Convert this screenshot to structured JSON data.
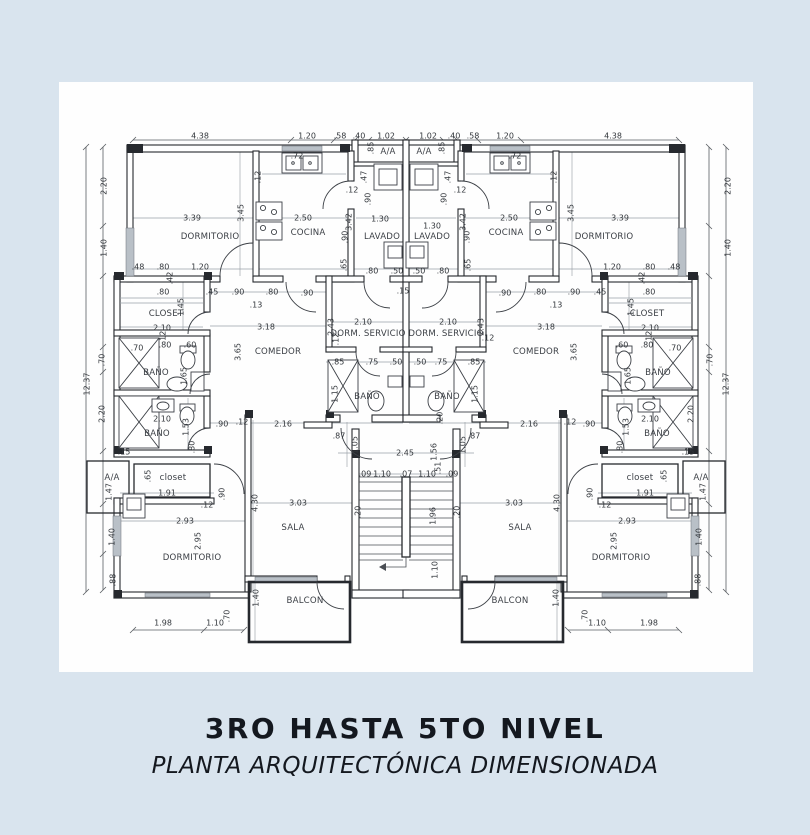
{
  "page": {
    "background": "#d9e4ee",
    "paper": "#fefefe",
    "ink": "#14181f",
    "line": "#26292e"
  },
  "titleblock": {
    "line1": "3RO HASTA 5TO NIVEL",
    "line2": "PLANTA ARQUITECTÓNICA DIMENSIONADA"
  },
  "plan": {
    "room_names": [
      "DORMITORIO",
      "COCINA",
      "LAVADO",
      "A/A",
      "CLOSET",
      "COMEDOR",
      "DORM. SERVICIO",
      "BAÑO",
      "SALA",
      "BALCON",
      "closet"
    ],
    "labels": [
      [
        "r",
        "DORMITORIO",
        210,
        237
      ],
      [
        "r",
        "COCINA",
        308,
        233
      ],
      [
        "r",
        "LAVADO",
        382,
        237
      ],
      [
        "r",
        "LAVADO",
        432,
        237
      ],
      [
        "r",
        "COCINA",
        506,
        233
      ],
      [
        "r",
        "DORMITORIO",
        604,
        237
      ],
      [
        "r",
        "A/A",
        388,
        152
      ],
      [
        "r",
        "A/A",
        424,
        152
      ],
      [
        "r",
        "CLOSET",
        166,
        314
      ],
      [
        "r",
        "CLOSET",
        647,
        314
      ],
      [
        "r",
        "COMEDOR",
        278,
        352
      ],
      [
        "r",
        "COMEDOR",
        536,
        352
      ],
      [
        "r",
        "DORM. SERVICIO",
        368,
        334
      ],
      [
        "r",
        "DORM. SERVICIO",
        446,
        334
      ],
      [
        "r",
        "BAÑO",
        156,
        373
      ],
      [
        "r",
        "BAÑO",
        658,
        373
      ],
      [
        "r",
        "BAÑO",
        367,
        397
      ],
      [
        "r",
        "BAÑO",
        447,
        397
      ],
      [
        "r",
        "BAÑO",
        157,
        434
      ],
      [
        "r",
        "BAÑO",
        657,
        434
      ],
      [
        "r",
        "A/A",
        112,
        478
      ],
      [
        "r",
        "closet",
        173,
        478
      ],
      [
        "r",
        "closet",
        640,
        478
      ],
      [
        "r",
        "A/A",
        701,
        478
      ],
      [
        "r",
        "DORMITORIO",
        192,
        558
      ],
      [
        "r",
        "DORMITORIO",
        621,
        558
      ],
      [
        "r",
        "SALA",
        293,
        528
      ],
      [
        "r",
        "SALA",
        520,
        528
      ],
      [
        "r",
        "BALCON",
        305,
        601
      ],
      [
        "r",
        "BALCON",
        510,
        601
      ],
      [
        "d",
        "4.38",
        200,
        136
      ],
      [
        "d",
        "1.20",
        307,
        136
      ],
      [
        "d",
        ".58",
        340,
        136
      ],
      [
        "d",
        ".40",
        359,
        136
      ],
      [
        "d",
        "1.02",
        386,
        136
      ],
      [
        "d",
        "1.02",
        428,
        136
      ],
      [
        "d",
        ".40",
        454,
        136
      ],
      [
        "d",
        ".58",
        473,
        136
      ],
      [
        "d",
        "1.20",
        505,
        136
      ],
      [
        "d",
        "4.38",
        613,
        136
      ],
      [
        "d",
        ".85",
        371,
        148,
        1
      ],
      [
        "d",
        ".85",
        442,
        148,
        1
      ],
      [
        "d",
        "2.20",
        104,
        186,
        1
      ],
      [
        "d",
        "1.40",
        104,
        248,
        1
      ],
      [
        "d",
        "12.37",
        87,
        384,
        1
      ],
      [
        "d",
        ".70",
        102,
        360,
        1
      ],
      [
        "d",
        "2.20",
        102,
        414,
        1
      ],
      [
        "d",
        "1.47",
        109,
        492,
        1
      ],
      [
        "d",
        "1.40",
        112,
        537,
        1
      ],
      [
        "d",
        ".88",
        113,
        580,
        1
      ],
      [
        "d",
        "2.20",
        728,
        186,
        1
      ],
      [
        "d",
        "1.40",
        728,
        248,
        1
      ],
      [
        "d",
        "12.37",
        726,
        384,
        1
      ],
      [
        "d",
        ".70",
        710,
        360,
        1
      ],
      [
        "d",
        "2.20",
        691,
        414,
        1
      ],
      [
        "d",
        "1.47",
        703,
        492,
        1
      ],
      [
        "d",
        "1.40",
        699,
        537,
        1
      ],
      [
        "d",
        ".88",
        698,
        580,
        1
      ],
      [
        "d",
        ".72",
        297,
        156
      ],
      [
        "d",
        "3.39",
        192,
        218
      ],
      [
        "d",
        "3.45",
        241,
        213,
        1
      ],
      [
        "d",
        "2.50",
        303,
        218
      ],
      [
        "d",
        ".12",
        258,
        177,
        1
      ],
      [
        "d",
        ".47",
        364,
        177,
        1
      ],
      [
        "d",
        ".90",
        368,
        199,
        1
      ],
      [
        "d",
        "1.30",
        380,
        219
      ],
      [
        "d",
        "3.42",
        349,
        222,
        1
      ],
      [
        "d",
        ".90",
        345,
        237,
        1
      ],
      [
        "d",
        ".65",
        344,
        265,
        1
      ],
      [
        "d",
        ".12",
        352,
        190
      ],
      [
        "d",
        ".72",
        515,
        156
      ],
      [
        "d",
        "3.39",
        620,
        218
      ],
      [
        "d",
        "3.45",
        571,
        213,
        1
      ],
      [
        "d",
        "2.50",
        509,
        218
      ],
      [
        "d",
        ".12",
        554,
        177,
        1
      ],
      [
        "d",
        ".47",
        448,
        177,
        1
      ],
      [
        "d",
        ".90",
        444,
        199,
        1
      ],
      [
        "d",
        "1.30",
        432,
        226
      ],
      [
        "d",
        "3.42",
        463,
        222,
        1
      ],
      [
        "d",
        ".90",
        467,
        237,
        1
      ],
      [
        "d",
        ".65",
        468,
        265,
        1
      ],
      [
        "d",
        ".12",
        460,
        190
      ],
      [
        "d",
        ".80",
        372,
        271
      ],
      [
        "d",
        ".50",
        397,
        271
      ],
      [
        "d",
        ".50",
        419,
        271
      ],
      [
        "d",
        ".80",
        443,
        271
      ],
      [
        "d",
        ".90",
        307,
        293
      ],
      [
        "d",
        ".90",
        505,
        293
      ],
      [
        "d",
        ".15",
        403,
        291
      ],
      [
        "d",
        ".48",
        138,
        267
      ],
      [
        "d",
        ".80",
        163,
        267
      ],
      [
        "d",
        "1.20",
        200,
        267
      ],
      [
        "d",
        ".42",
        170,
        278,
        1
      ],
      [
        "d",
        ".80",
        163,
        292
      ],
      [
        "d",
        ".45",
        212,
        292
      ],
      [
        "d",
        ".90",
        238,
        292
      ],
      [
        "d",
        ".80",
        272,
        292
      ],
      [
        "d",
        ".13",
        256,
        305
      ],
      [
        "d",
        ".48",
        674,
        267
      ],
      [
        "d",
        ".80",
        649,
        267
      ],
      [
        "d",
        "1.20",
        612,
        267
      ],
      [
        "d",
        ".42",
        642,
        278,
        1
      ],
      [
        "d",
        ".80",
        649,
        292
      ],
      [
        "d",
        ".45",
        600,
        292
      ],
      [
        "d",
        ".90",
        574,
        292
      ],
      [
        "d",
        ".80",
        540,
        292
      ],
      [
        "d",
        ".13",
        556,
        305
      ],
      [
        "d",
        "1.45",
        181,
        307,
        1
      ],
      [
        "d",
        "2.10",
        162,
        328
      ],
      [
        "d",
        ".12",
        163,
        337,
        1
      ],
      [
        "d",
        "1.45",
        631,
        307,
        1
      ],
      [
        "d",
        "2.10",
        650,
        328
      ],
      [
        "d",
        ".12",
        649,
        337,
        1
      ],
      [
        "d",
        ".70",
        137,
        348
      ],
      [
        "d",
        ".80",
        165,
        345
      ],
      [
        "d",
        ".60",
        190,
        345
      ],
      [
        "d",
        "1.65",
        184,
        376,
        1
      ],
      [
        "d",
        ".70",
        675,
        348
      ],
      [
        "d",
        ".80",
        647,
        345
      ],
      [
        "d",
        ".60",
        622,
        345
      ],
      [
        "d",
        "1.65",
        628,
        376,
        1
      ],
      [
        "d",
        "2.10",
        162,
        419
      ],
      [
        "d",
        "1.53",
        186,
        427,
        1
      ],
      [
        "d",
        ".80",
        192,
        447,
        1
      ],
      [
        "d",
        ".15",
        124,
        452
      ],
      [
        "d",
        "2.10",
        650,
        419
      ],
      [
        "d",
        "1.53",
        626,
        427,
        1
      ],
      [
        "d",
        ".80",
        620,
        447,
        1
      ],
      [
        "d",
        ".15",
        688,
        452
      ],
      [
        "d",
        "3.18",
        266,
        327
      ],
      [
        "d",
        "3.65",
        238,
        352,
        1
      ],
      [
        "d",
        "3.18",
        546,
        327
      ],
      [
        "d",
        "3.65",
        574,
        352,
        1
      ],
      [
        "d",
        "2.10",
        363,
        322
      ],
      [
        "d",
        "2.10",
        448,
        322
      ],
      [
        "d",
        "2.43",
        331,
        327,
        1
      ],
      [
        "d",
        "2.43",
        481,
        327,
        1
      ],
      [
        "d",
        ".12",
        336,
        339,
        1
      ],
      [
        "d",
        ".12",
        488,
        338
      ],
      [
        "d",
        ".85",
        338,
        362
      ],
      [
        "d",
        ".75",
        372,
        362
      ],
      [
        "d",
        ".50",
        396,
        362
      ],
      [
        "d",
        ".50",
        420,
        362
      ],
      [
        "d",
        ".75",
        441,
        362
      ],
      [
        "d",
        ".85",
        474,
        362
      ],
      [
        "d",
        "1.15",
        335,
        394,
        1
      ],
      [
        "d",
        "1.15",
        475,
        394,
        1
      ],
      [
        "d",
        ".20",
        440,
        418,
        1
      ],
      [
        "d",
        ".90",
        222,
        424
      ],
      [
        "d",
        ".12",
        242,
        422
      ],
      [
        "d",
        "2.16",
        283,
        424
      ],
      [
        "d",
        "2.16",
        529,
        424
      ],
      [
        "d",
        ".12",
        570,
        422
      ],
      [
        "d",
        ".90",
        589,
        424
      ],
      [
        "d",
        ".90",
        222,
        494,
        1
      ],
      [
        "d",
        ".12",
        207,
        505
      ],
      [
        "d",
        ".90",
        590,
        494,
        1
      ],
      [
        "d",
        ".12",
        605,
        505
      ],
      [
        "d",
        ".65",
        148,
        476,
        1
      ],
      [
        "d",
        "1.91",
        167,
        493
      ],
      [
        "d",
        "2.93",
        185,
        521
      ],
      [
        "d",
        "2.95",
        198,
        541,
        1
      ],
      [
        "d",
        "4.30",
        255,
        503,
        1
      ],
      [
        "d",
        "3.03",
        298,
        503
      ],
      [
        "d",
        "1.40",
        256,
        598,
        1
      ],
      [
        "d",
        "1.98",
        163,
        623
      ],
      [
        "d",
        "1.10",
        215,
        623
      ],
      [
        "d",
        ".70",
        227,
        616,
        1
      ],
      [
        "d",
        ".65",
        664,
        476,
        1
      ],
      [
        "d",
        "1.91",
        645,
        493
      ],
      [
        "d",
        "2.93",
        627,
        521
      ],
      [
        "d",
        "2.95",
        614,
        541,
        1
      ],
      [
        "d",
        "4.30",
        557,
        503,
        1
      ],
      [
        "d",
        "3.03",
        514,
        503
      ],
      [
        "d",
        "1.40",
        556,
        598,
        1
      ],
      [
        "d",
        "1.98",
        649,
        623
      ],
      [
        "d",
        "1.10",
        597,
        623
      ],
      [
        "d",
        ".70",
        585,
        616,
        1
      ],
      [
        "d",
        ".87",
        339,
        436
      ],
      [
        "d",
        "1.05",
        355,
        445,
        1
      ],
      [
        "d",
        ".87",
        474,
        436
      ],
      [
        "d",
        "1.05",
        463,
        445,
        1
      ],
      [
        "d",
        "2.45",
        405,
        453
      ],
      [
        "d",
        "1.56",
        434,
        452,
        1
      ],
      [
        "d",
        ".09",
        365,
        474
      ],
      [
        "d",
        "1.10",
        382,
        474
      ],
      [
        "d",
        ".07",
        406,
        474
      ],
      [
        "d",
        "1.10",
        427,
        474
      ],
      [
        "d",
        ".51",
        438,
        468,
        1
      ],
      [
        "d",
        ".09",
        452,
        474
      ],
      [
        "d",
        "1.96",
        433,
        516,
        1
      ],
      [
        "d",
        "1.10",
        435,
        570,
        1
      ],
      [
        "d",
        ".20",
        358,
        512,
        1
      ],
      [
        "d",
        ".20",
        457,
        512,
        1
      ]
    ]
  }
}
